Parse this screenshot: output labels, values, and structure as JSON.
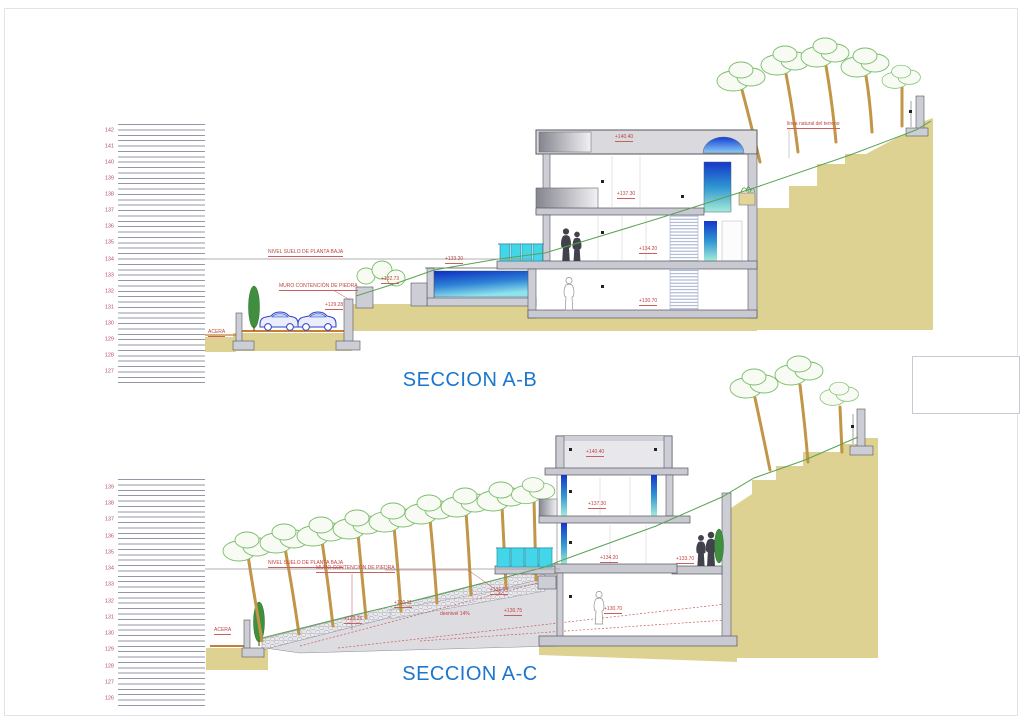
{
  "page": {
    "background": "#ffffff",
    "frame_color": "#e2e2ea"
  },
  "sections": [
    {
      "id": "seccion-ab",
      "title": "SECCION A-B",
      "ruler": {
        "values": [
          142,
          141,
          140,
          139,
          138,
          137,
          136,
          135,
          134,
          133,
          132,
          131,
          130,
          129,
          128,
          127
        ]
      },
      "labels": {
        "nivel_suelo": "NIVEL SUELO DE PLANTA BAJA",
        "muro": "MURO CONTENCIÓN DE PIEDRA",
        "acera": "ACERA",
        "linea_terreno": "linea natural del terreno"
      },
      "elevations": {
        "roof": "+140.40",
        "first_floor": "+137.30",
        "ground_floor": "+134.20",
        "basement": "+130.70",
        "pool": "+133.20",
        "garden": "+132.73",
        "street_wall": "+129.28"
      }
    },
    {
      "id": "seccion-ac",
      "title": "SECCION A-C",
      "ruler": {
        "values": [
          139,
          138,
          137,
          136,
          135,
          134,
          133,
          132,
          131,
          130,
          129,
          128,
          127,
          126
        ]
      },
      "labels": {
        "nivel_suelo": "NIVEL SUELO DE PLANTA BAJA",
        "muro": "MURO CONTENCIÓN DE PIEDRA",
        "acera": "ACERA"
      },
      "elevations": {
        "roof": "+140.40",
        "first_floor": "+137.30",
        "ground_floor": "+134.20",
        "terrace": "+133.70",
        "basement": "+130.70",
        "slope_1": "+129.25",
        "slope_2": "+130.11",
        "slope_3": "+131.04",
        "slope_4": "+130.75",
        "slope_grade": "desnivel 14%"
      }
    }
  ],
  "colors": {
    "title_blue": "#1b76cc",
    "annotation_red": "#c04545",
    "terrain_tan": "#ded293",
    "tree_green": "#7bbd6b",
    "water_dark": "#0e2cc2",
    "water_light": "#8fe4ec",
    "railing_cyan": "#43d6e8"
  }
}
